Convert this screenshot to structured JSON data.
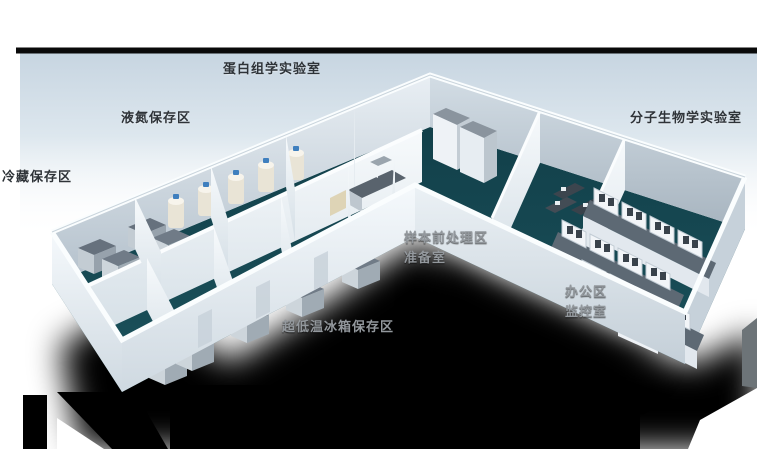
{
  "floorplan": {
    "title_note": "L-shaped biobank laboratory 3D floor plan",
    "labels": {
      "proteomics_lab": "蛋白组学实验室",
      "liquid_nitrogen_area": "液氮保存区",
      "cold_storage_area": "冷藏保存区",
      "molecular_biology_lab": "分子生物学实验室",
      "sample_pretreatment_area": "样本前处理区",
      "preparation_room": "准备室",
      "office_area": "办公区",
      "monitoring_room": "监控室",
      "ult_freezer_storage_area": "超低温冰箱保存区"
    },
    "colors": {
      "floor_teal": "#17474f",
      "wall_light": "#eaf0f5",
      "background_panel_blue": "#c9d7e2",
      "top_band_black": "#0a0a0a",
      "shadow_black": "#000000",
      "label_dark": "#2e3338",
      "label_light": "#93989d",
      "nitrogen_tank_cap_blue": "#3f7fbe",
      "equipment_gray": "#66717d"
    }
  }
}
